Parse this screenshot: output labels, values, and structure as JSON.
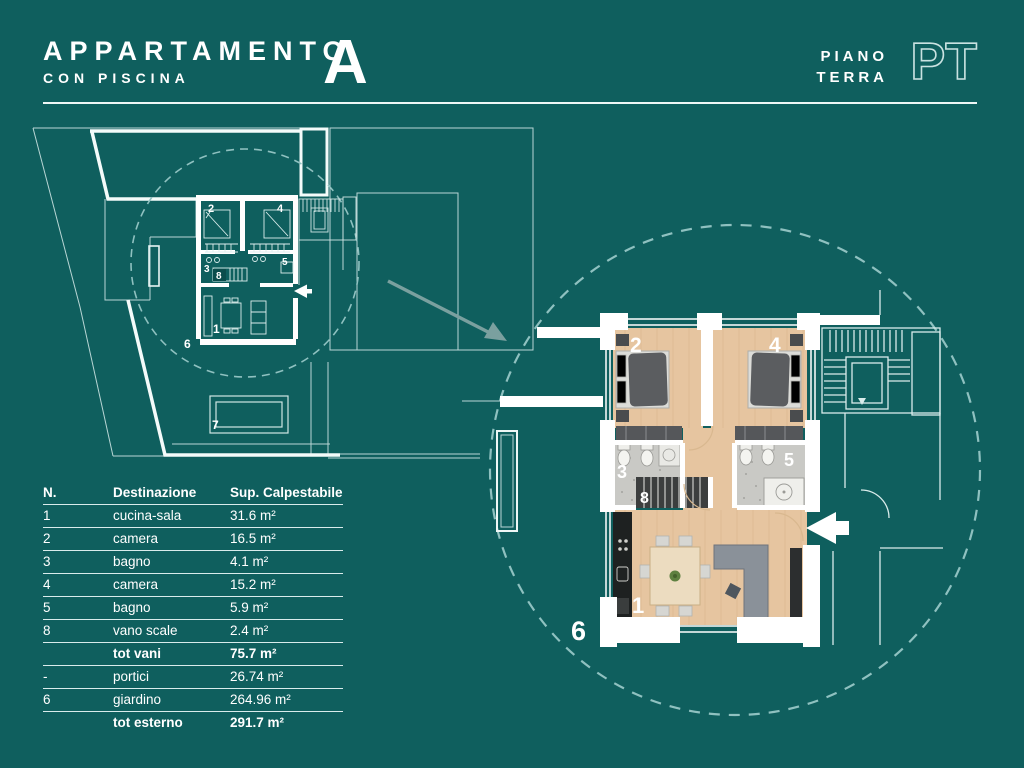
{
  "header": {
    "title": "APPARTAMENTO",
    "subtitle": "CON PISCINA",
    "unit_letter": "A",
    "floor_label_line1": "PIANO",
    "floor_label_line2": "TERRA",
    "floor_code": "PT"
  },
  "table": {
    "columns": {
      "n": "N.",
      "destinazione": "Destinazione",
      "sup": "Sup. Calpestabile"
    },
    "rows": [
      {
        "n": "1",
        "dest": "cucina-sala",
        "sup": "31.6 m²"
      },
      {
        "n": "2",
        "dest": "camera",
        "sup": "16.5 m²"
      },
      {
        "n": "3",
        "dest": "bagno",
        "sup": "4.1 m²"
      },
      {
        "n": "4",
        "dest": "camera",
        "sup": "15.2 m²"
      },
      {
        "n": "5",
        "dest": "bagno",
        "sup": "5.9 m²"
      },
      {
        "n": "8",
        "dest": "vano scale",
        "sup": "2.4 m²"
      },
      {
        "n": "",
        "dest": "tot vani",
        "sup": "75.7 m²"
      },
      {
        "n": "-",
        "dest": "portici",
        "sup": "26.74 m²"
      },
      {
        "n": "6",
        "dest": "giardino",
        "sup": "264.96 m²"
      },
      {
        "n": "",
        "dest": "tot esterno",
        "sup": "291.7 m²"
      }
    ]
  },
  "site_plan": {
    "labels": {
      "living": "1",
      "bedroom_a": "2",
      "bath_a": "3",
      "bedroom_b": "4",
      "bath_b": "5",
      "garden": "6",
      "pool": "7",
      "stairs": "8"
    }
  },
  "zoom_plan": {
    "labels": {
      "living": "1",
      "bedroom_a": "2",
      "bath_a": "3",
      "bedroom_b": "4",
      "bath_b": "5",
      "garden": "6",
      "stairs": "8"
    }
  },
  "colors": {
    "background": "#0f5f5e",
    "line_white": "#ffffff",
    "thin_line": "#c2dcdb",
    "dashed_circle": "#8fc1c0",
    "wood_floor": "#e6c5a0",
    "bath_floor": "#c9c9c5",
    "dark_furniture": "#55575a",
    "arrow_gray": "#7aa09f"
  }
}
